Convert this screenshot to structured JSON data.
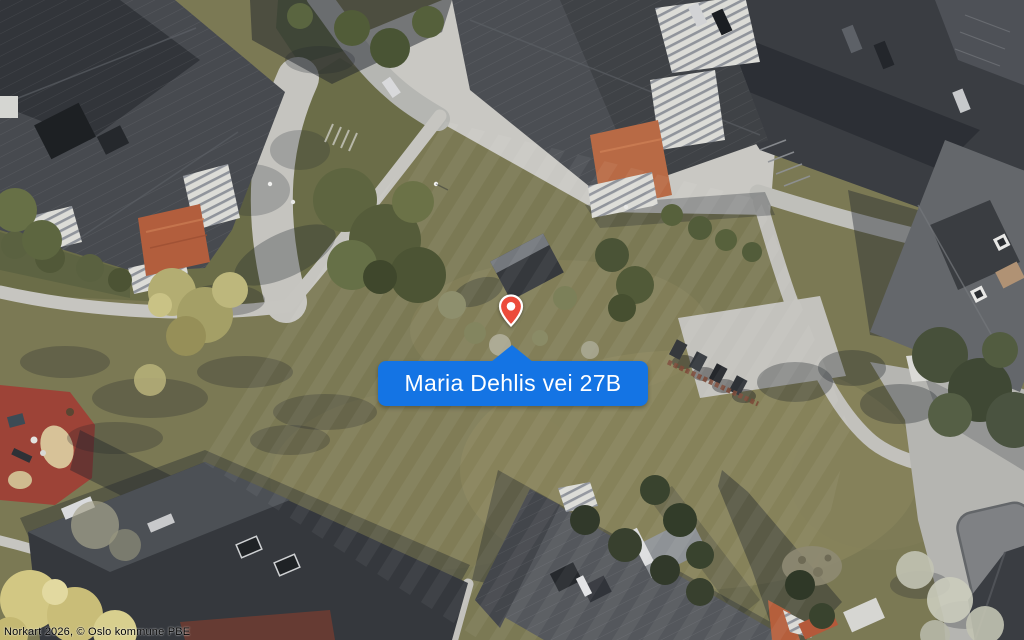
{
  "callout": {
    "label": "Maria Dehlis vei 27B",
    "background_color": "#1474e4",
    "text_color": "#ffffff"
  },
  "pin": {
    "icon": "map-pin",
    "color": "#ec4b3b",
    "outline_color": "#ffffff"
  },
  "attribution": {
    "text": "Norkart 2026, © Oslo kommune PBE"
  }
}
